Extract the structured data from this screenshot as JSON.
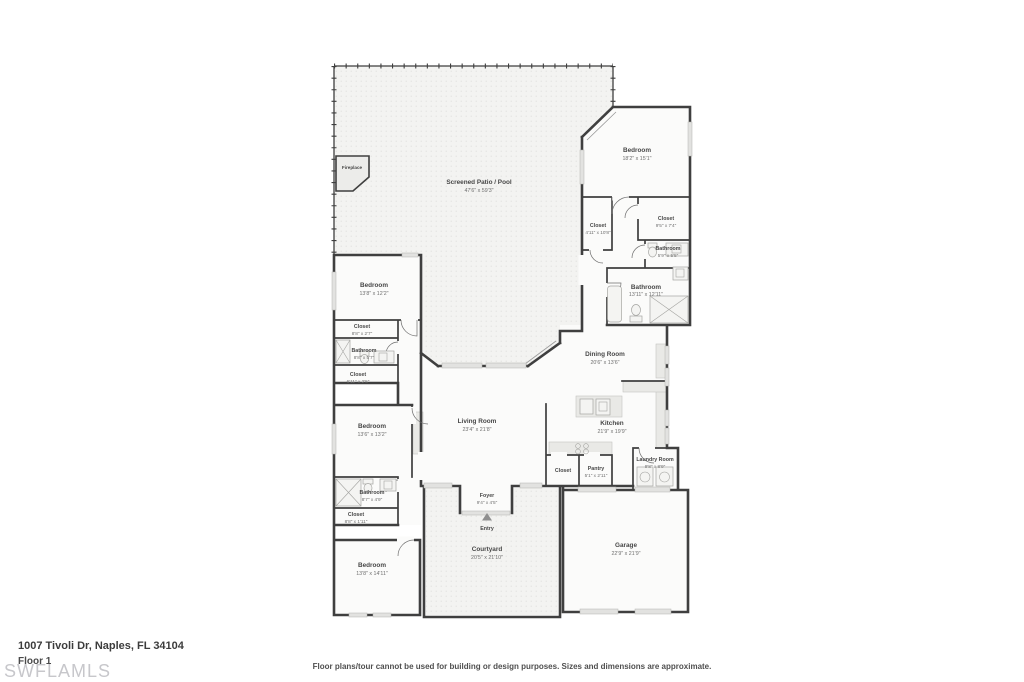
{
  "page": {
    "address": "1007 Tivoli Dr, Naples, FL 34104",
    "floor_label": "Floor 1",
    "watermark": "SWFLAMLS",
    "disclaimer": "Floor plans/tour cannot be used for building or design purposes. Sizes and dimensions are approximate."
  },
  "colors": {
    "wall": "#3f3f3f",
    "room_fill": "#fbfbfa",
    "outdoor_bg": "#f3f3f1",
    "outdoor_dot": "#dbdbd8",
    "counter_fill": "#e9e9e6",
    "window_fill": "#e2e2e0",
    "label": "#474747",
    "label_dim": "#6f6f6f",
    "watermark_color": "#c7c7cb",
    "text_dark": "#3c3c3c",
    "disclaimer_color": "#4f4f4f"
  },
  "rooms": {
    "screened_patio": {
      "name": "Screened Patio / Pool",
      "dims": "47'6\" x 59'3\""
    },
    "fireplace": {
      "name": "Fireplace"
    },
    "bedroom_master": {
      "name": "Bedroom",
      "dims": "18'2\" x 15'1\""
    },
    "closet_master_left": {
      "name": "Closet",
      "dims": "4'11\" x 10'8\""
    },
    "closet_master_right": {
      "name": "Closet",
      "dims": "9'5\" x 7'4\""
    },
    "bathroom_small": {
      "name": "Bathroom",
      "dims": "5'9\" x 5'5\""
    },
    "bathroom_master": {
      "name": "Bathroom",
      "dims": "13'11\" x 12'11\""
    },
    "bedroom_2": {
      "name": "Bedroom",
      "dims": "13'8\" x 12'2\""
    },
    "closet_2": {
      "name": "Closet",
      "dims": "8'8\" x 2'7\""
    },
    "bathroom_2": {
      "name": "Bathroom",
      "dims": "8'8\" x 5'7\""
    },
    "closet_3": {
      "name": "Closet",
      "dims": "6'11\" x 2'5\""
    },
    "dining_room": {
      "name": "Dining Room",
      "dims": "20'6\" x 13'6\""
    },
    "living_room": {
      "name": "Living Room",
      "dims": "23'4\" x 21'8\""
    },
    "kitchen": {
      "name": "Kitchen",
      "dims": "21'9\" x 19'9\""
    },
    "bedroom_3": {
      "name": "Bedroom",
      "dims": "13'6\" x 13'2\""
    },
    "bathroom_3": {
      "name": "Bathroom",
      "dims": "8'7\" x 4'9\""
    },
    "closet_4": {
      "name": "Closet",
      "dims": "8'8\" x 1'11\""
    },
    "foyer": {
      "name": "Foyer",
      "dims": "9'4\" x 4'5\""
    },
    "entry": {
      "name": "Entry"
    },
    "courtyard": {
      "name": "Courtyard",
      "dims": "20'5\" x 21'10\""
    },
    "garage": {
      "name": "Garage",
      "dims": "22'9\" x 21'9\""
    },
    "laundry_room": {
      "name": "Laundry Room",
      "dims": "9'8\" x 8'9\""
    },
    "closet_kitchen": {
      "name": "Closet"
    },
    "pantry": {
      "name": "Pantry",
      "dims": "5'1\" x 2'11\""
    },
    "bedroom_4": {
      "name": "Bedroom",
      "dims": "13'8\" x 14'11\""
    }
  }
}
